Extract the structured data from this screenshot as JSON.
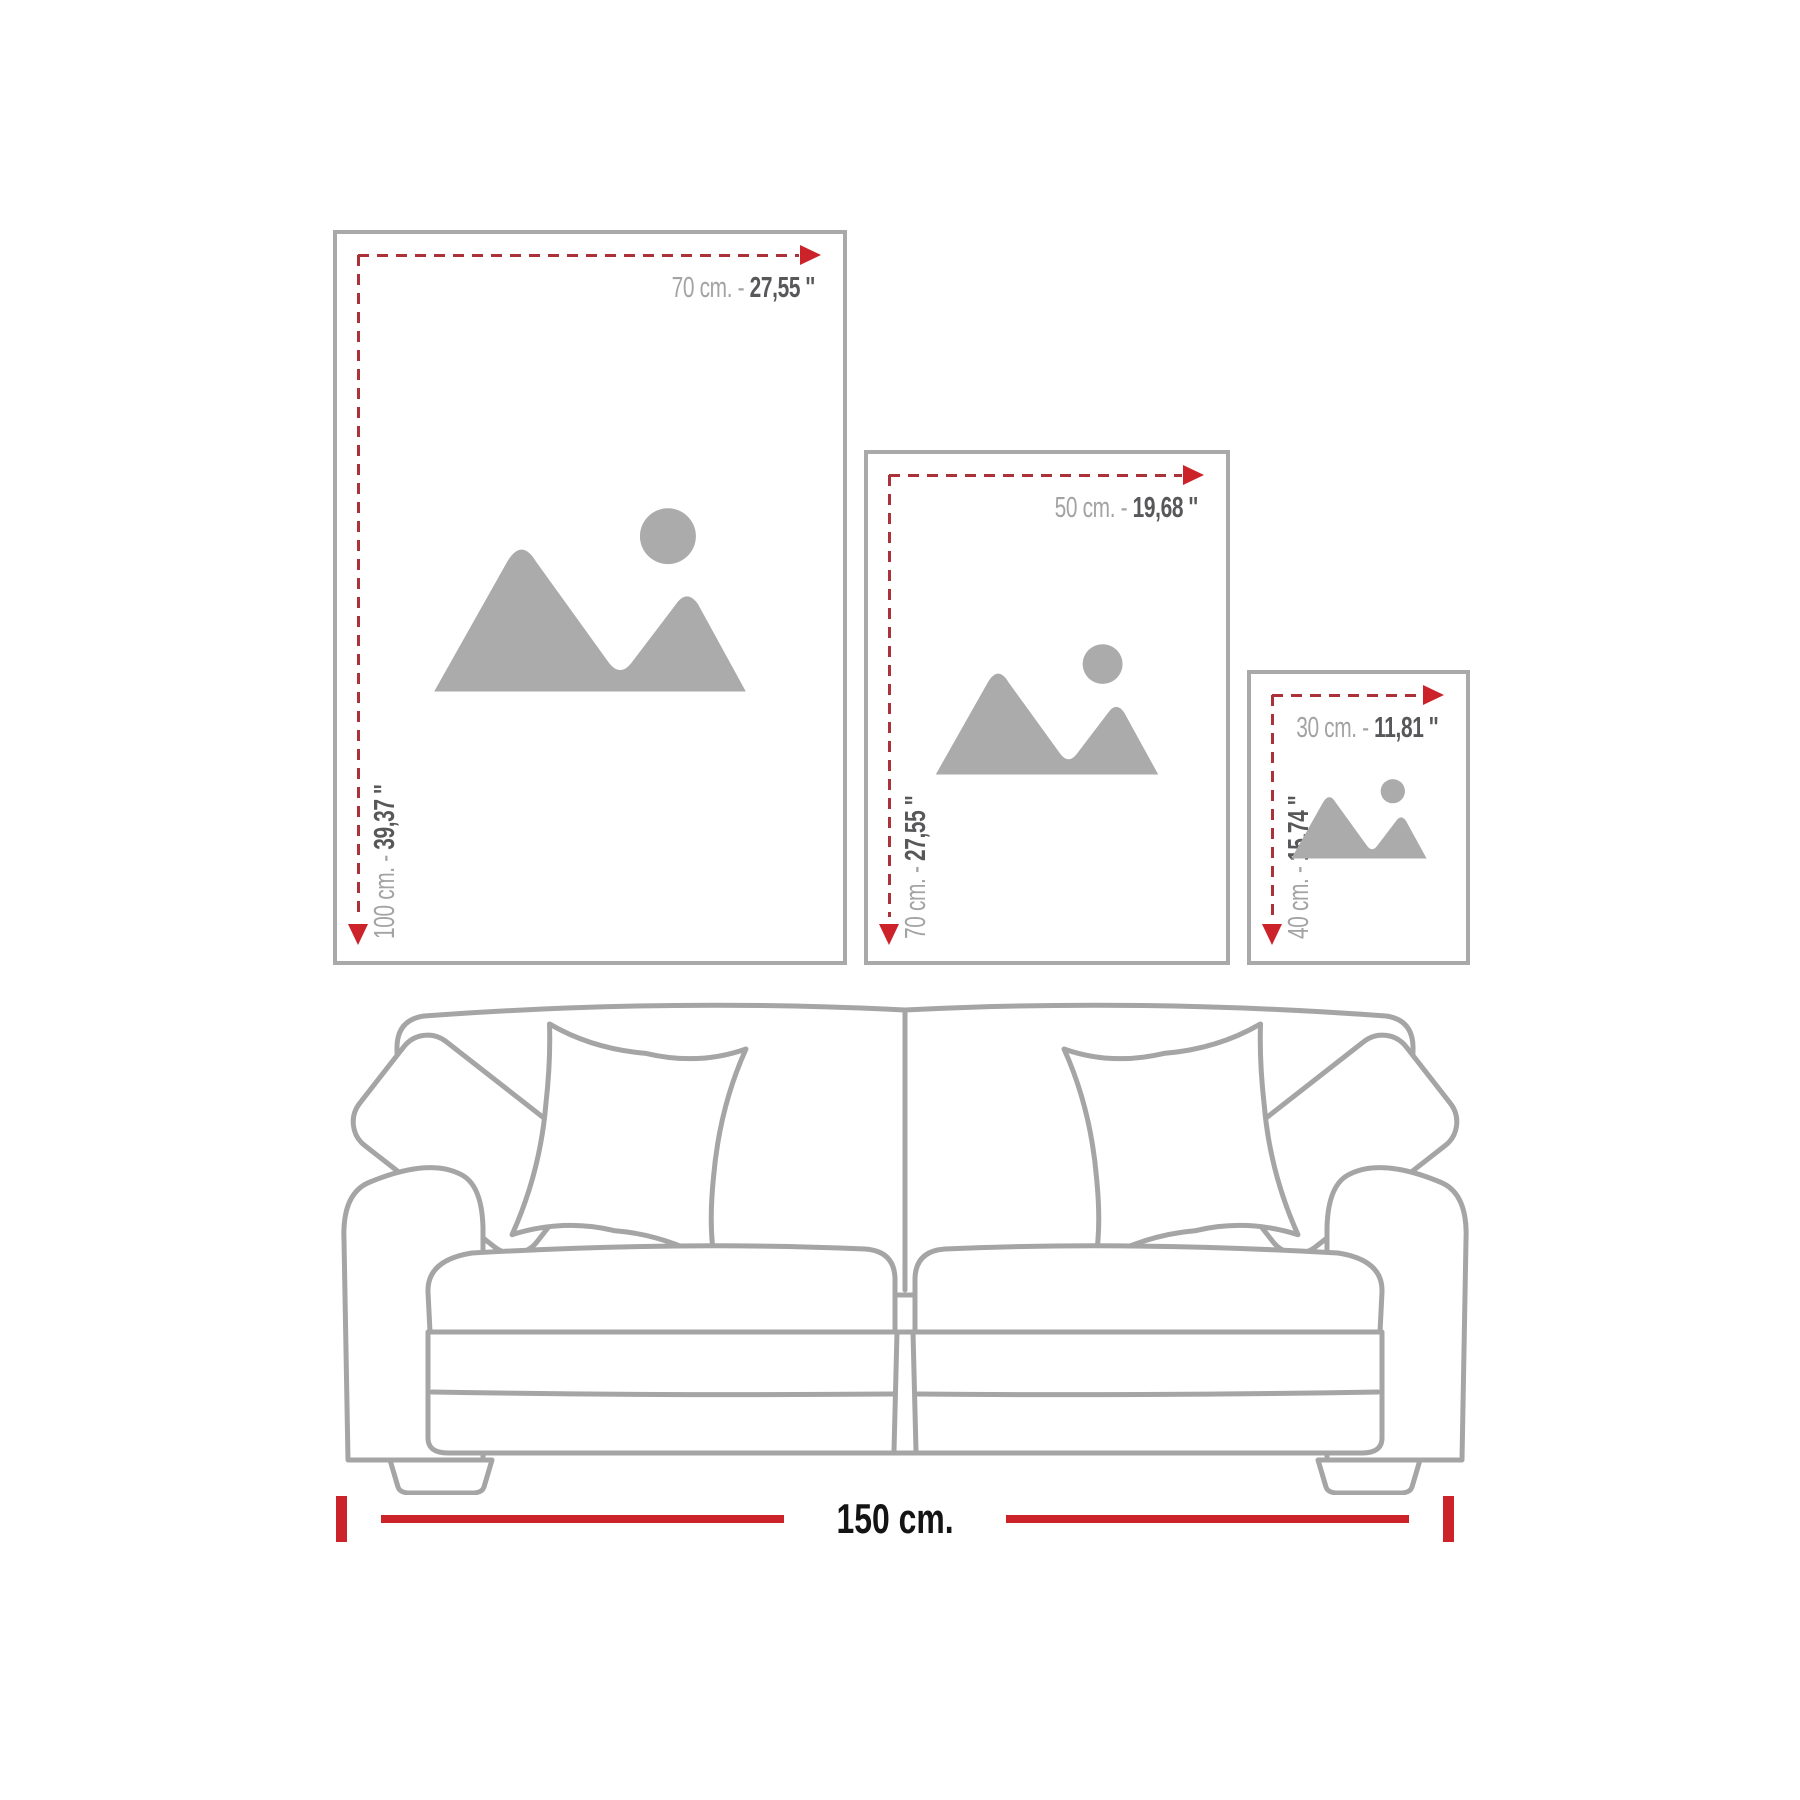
{
  "frames": [
    {
      "size": "large",
      "width_cm": "70 cm. -",
      "width_in": "27,55 ''",
      "height_cm": "100 cm. -",
      "height_in": "39,37 ''"
    },
    {
      "size": "medium",
      "width_cm": "50 cm. -",
      "width_in": "19,68 ''",
      "height_cm": "70 cm. -",
      "height_in": "27,55 ''"
    },
    {
      "size": "small",
      "width_cm": "30 cm. -",
      "width_in": "11,81 ''",
      "height_cm": "40 cm. -",
      "height_in": "15,74 ''"
    }
  ],
  "sofa": {
    "width_label": "150 cm."
  },
  "icons": {
    "placeholder": "image-placeholder-mountain-sun",
    "horizontal_arrow": "right-arrow",
    "vertical_arrow": "down-arrow"
  },
  "colors": {
    "accent_red": "#cc2229",
    "dash_red": "#ab3238",
    "frame_border": "#a9a9a9",
    "label_gray": "#a3a3a3",
    "label_dark": "#58585a",
    "placeholder_gray": "#ababab",
    "sofa_line": "#a5a5a5",
    "measure_text": "#141414"
  }
}
